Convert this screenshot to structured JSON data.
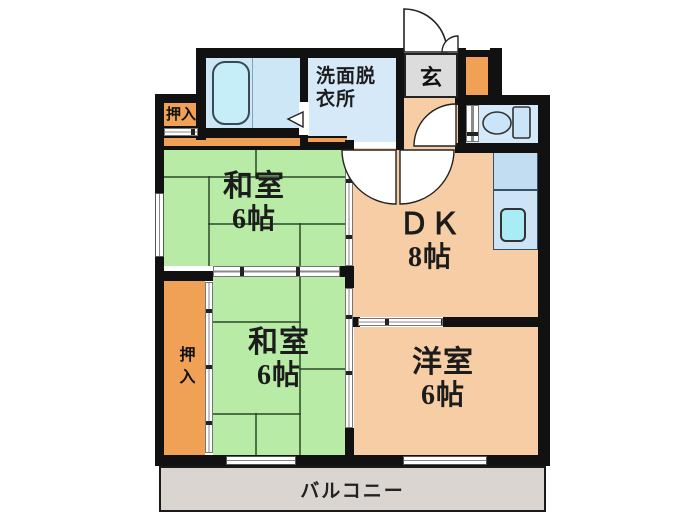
{
  "plan": {
    "type": "apartment-floorplan",
    "rooms": {
      "washitsu_upper": {
        "name": "和室",
        "size": "6帖"
      },
      "washitsu_lower": {
        "name": "和室",
        "size": "6帖"
      },
      "dk": {
        "name": "ＤＫ",
        "size": "8帖"
      },
      "youshitsu": {
        "name": "洋室",
        "size": "6帖"
      },
      "senmen": {
        "line1": "洗面脱",
        "line2": "衣所"
      },
      "genkan": {
        "name": "玄"
      },
      "oshiire_top": {
        "name": "押入"
      },
      "oshiire_side": {
        "name": "押入"
      },
      "balcony": {
        "name": "バルコニー"
      }
    },
    "fixtures": {
      "bathtub": "bathtub",
      "toilet": "toilet",
      "kitchen_sink": "kitchen-sink"
    },
    "colors": {
      "tatami_green": "#b7eba6",
      "room_peach": "#f6cda4",
      "closet_orange": "#f0a156",
      "water_blue": "#d6e9f8",
      "bath_floor": "#cde7f7",
      "bathtub_cyan": "#c6eef8",
      "sink_cyan": "#a9ecf5",
      "kitchen_blue": "#c2ddf2",
      "genkan_gray": "#dcdcdc",
      "balcony_gray": "#dad5d1",
      "wall_black": "#111111"
    }
  }
}
